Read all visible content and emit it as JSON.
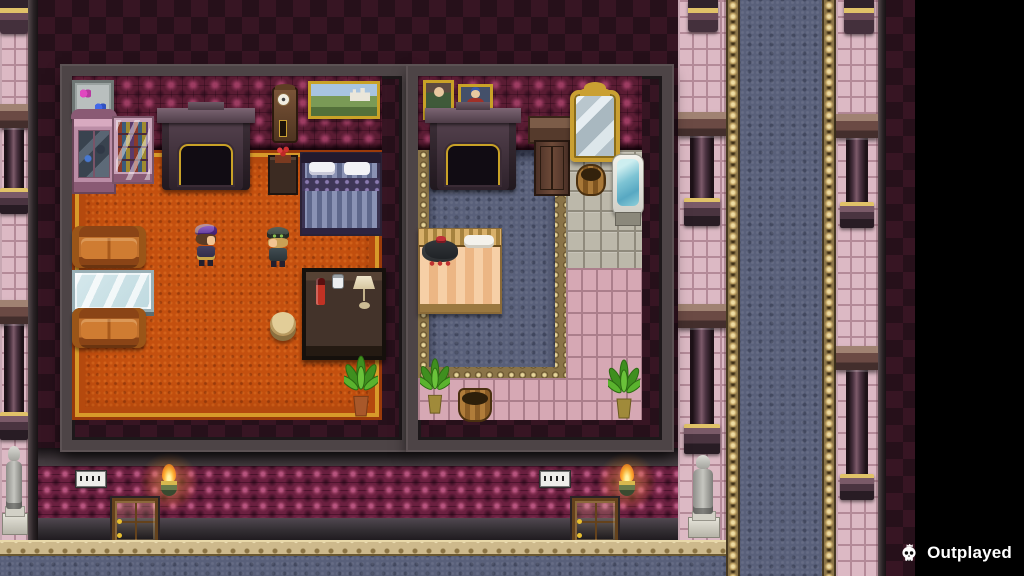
{
  "watermark": {
    "label": "Outplayed",
    "icon": "skull-crown-icon"
  },
  "palette": {
    "letterbox_black": "#000000",
    "diamond_wall_dark": "#26101a",
    "diamond_wall_light": "#371523",
    "room_wallpaper": "#5a1c33",
    "hall_wallpaper": "#6b2040",
    "orange_carpet": "#c4500f",
    "blue_carpet": "#59607a",
    "pink_brick": "#dcb9c4",
    "stone_tile": "#bcb8aa",
    "pink_tile": "#d6a8b4",
    "gold_trim": "#cdb98c",
    "torch_flame": "#ffb437",
    "couch_leather": "#c0702c"
  },
  "scene": {
    "left_room": {
      "name": "parlor",
      "furniture": [
        "butterfly-display",
        "curio-cabinet",
        "bookshelf",
        "fireplace",
        "grandfather-clock",
        "landscape-painting",
        "flower-table",
        "double-bed-purple",
        "couch-top",
        "glass-table",
        "couch-bottom",
        "stool",
        "side-desk",
        "potted-plant"
      ],
      "characters": [
        "npc-purple-hat",
        "npc-goggle-cap"
      ]
    },
    "right_room": {
      "name": "bedroom",
      "furniture": [
        "portrait-lady",
        "portrait-man",
        "fireplace",
        "side-table",
        "armoire",
        "standing-mirror",
        "basket",
        "bathtub",
        "single-bed-peach",
        "potted-plant-left",
        "wooden-bucket",
        "potted-plant-right"
      ],
      "characters": [
        "npc-sleeping"
      ]
    },
    "hallway": {
      "signs": 2,
      "doors": 2,
      "torches": 2,
      "knight_statues": 2
    }
  }
}
